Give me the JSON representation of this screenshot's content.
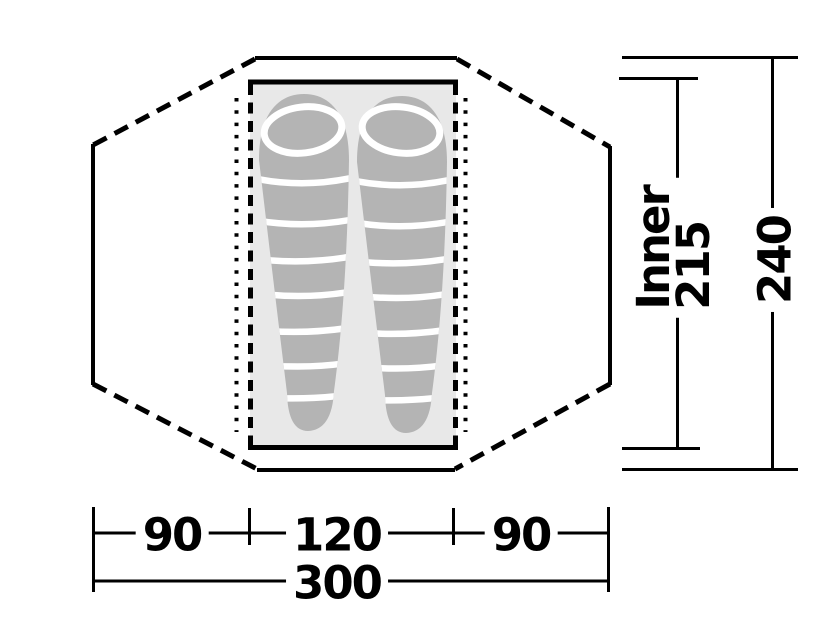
{
  "diagram": {
    "kind": "tent-floorplan",
    "sleeping_bags_count": 2
  },
  "colors": {
    "line": "#000000",
    "floor": "#e8e8e8",
    "bag": "#b4b4b4",
    "stripe": "#ffffff",
    "background": "#ffffff",
    "text": "#000000"
  },
  "dimensions": {
    "bottom": {
      "segments": [
        {
          "label": "90"
        },
        {
          "label": "120"
        },
        {
          "label": "90"
        }
      ],
      "total": {
        "label": "300"
      }
    },
    "right": {
      "inner": {
        "word": "Inner",
        "value": "215"
      },
      "outer": {
        "value": "240"
      }
    }
  }
}
